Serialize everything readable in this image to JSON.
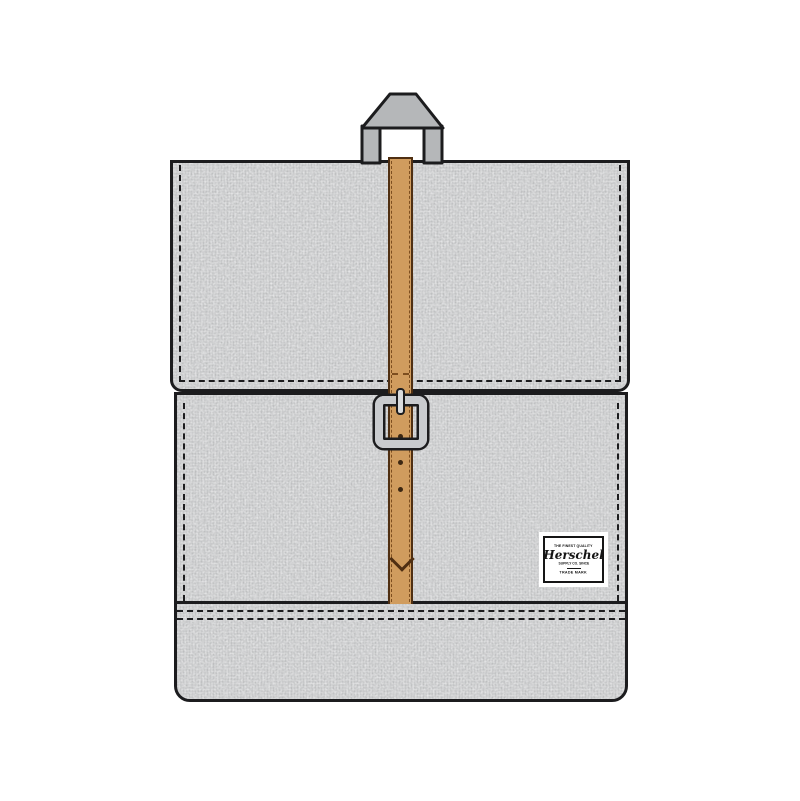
{
  "scene": {
    "type": "product-illustration",
    "subject": "fold-over buckle backpack line drawing on white background"
  },
  "colors": {
    "fabric": "#c8c9ca",
    "outline": "#1c1c1e",
    "strap": "#d09c5e",
    "strap_outline": "#4f2f12",
    "strap_stitch": "#7d4e1f",
    "strap_hole": "#3c2712",
    "handle": "#b5b7b9",
    "buckle": "#c9cbce",
    "buckle_prong": "#d9dbdd",
    "label_bg": "#ffffff",
    "label_border": "#151515",
    "label_text": "#151515"
  },
  "label": {
    "top_text": "THE FINEST QUALITY",
    "brand": "Herschel",
    "sub_text": "SUPPLY CO. SINCE",
    "bottom_text": "TRADE MARK"
  },
  "strap": {
    "hole_count": 3
  }
}
